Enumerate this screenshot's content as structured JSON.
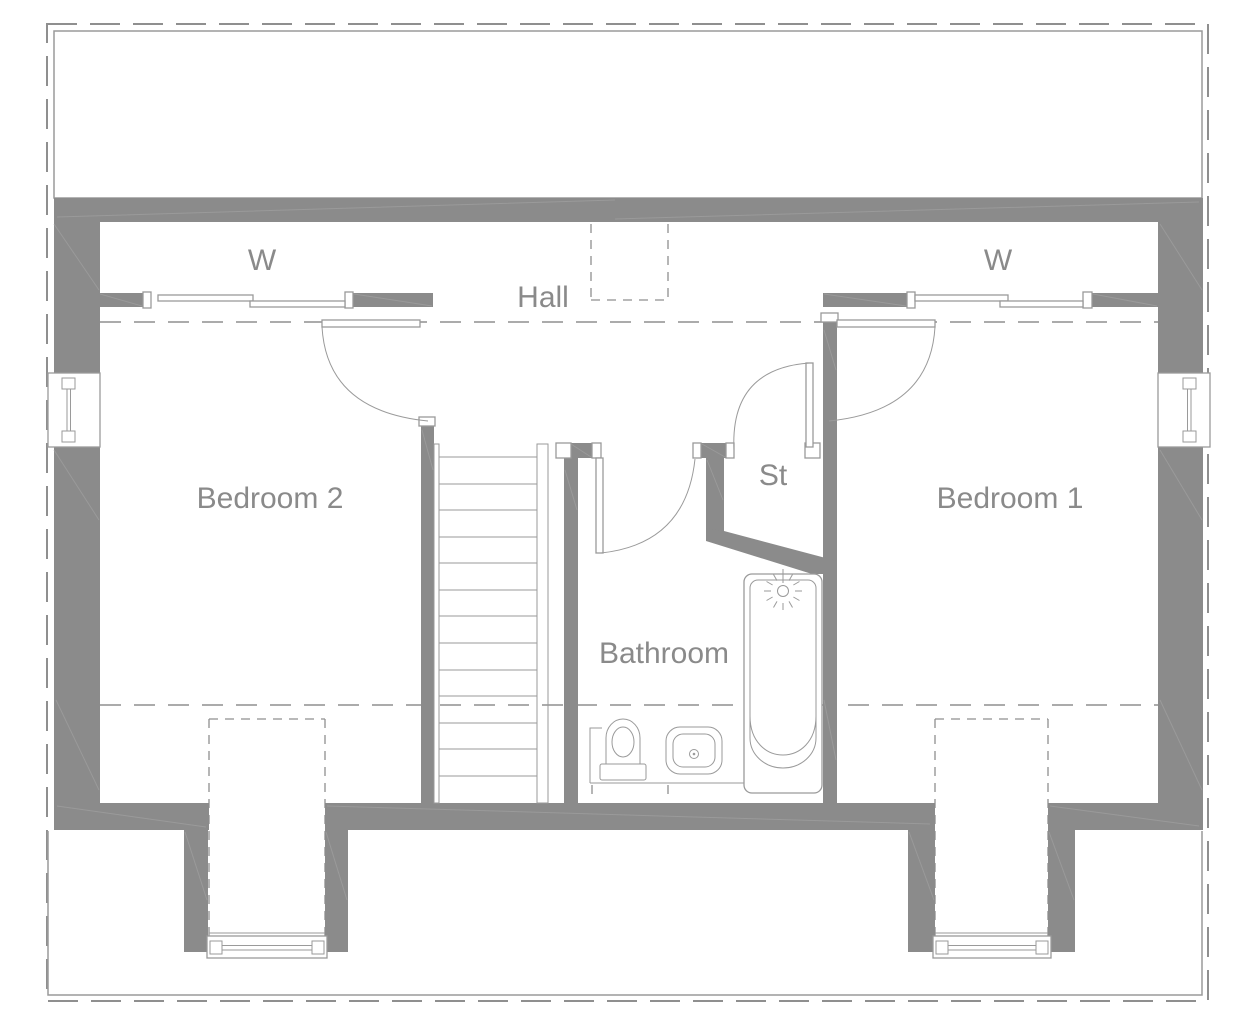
{
  "title": "First floor plan",
  "rooms": {
    "bedroom2": "Bedroom 2",
    "bedroom1": "Bedroom 1",
    "hall": "Hall",
    "bathroom": "Bathroom",
    "storage": "St",
    "wardrobe_left": "W",
    "wardrobe_right": "W"
  },
  "colors": {
    "bg": "#ffffff",
    "wall": "#8b8b8b",
    "line": "#9a9a9a",
    "hatch": "#9c9c9c",
    "dash": "#8f8f8f",
    "text": "#8a8a8a"
  }
}
